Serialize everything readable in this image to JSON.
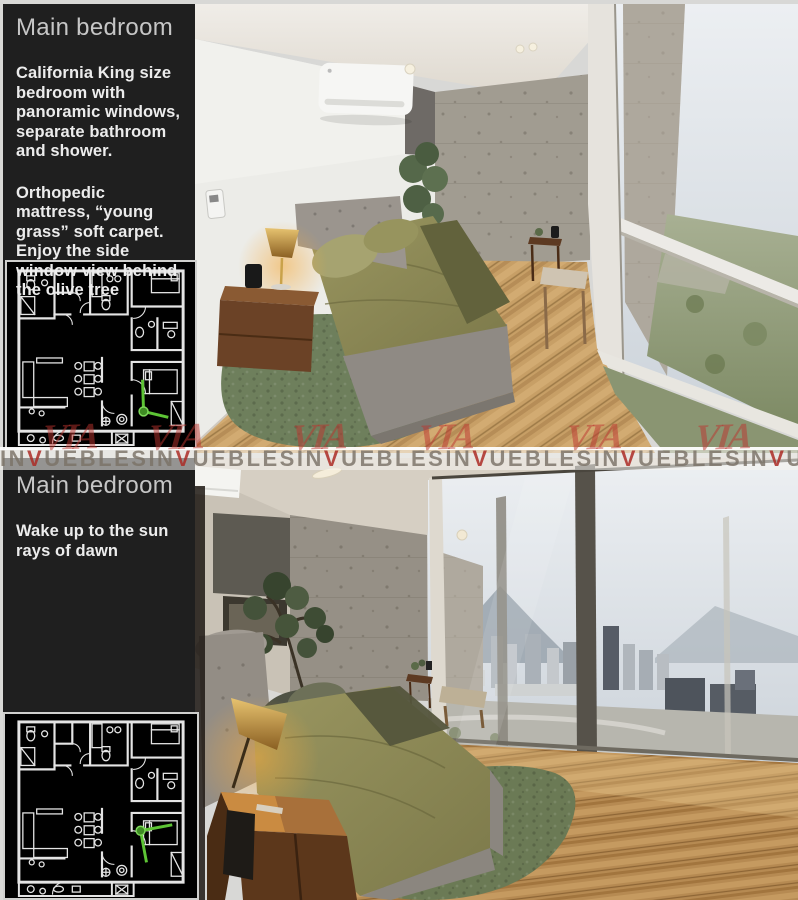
{
  "sections": [
    {
      "title": "Main bedroom",
      "paragraphs": [
        "California King size bedroom with panoramic windows, separate bathroom and shower.",
        "Orthopedic mattress, “young grass” soft carpet. Enjoy the side window view behind the olive tree"
      ]
    },
    {
      "title": "Main bedroom",
      "paragraphs": [
        "Wake up to the sun rays of dawn"
      ]
    }
  ],
  "watermark": {
    "prefix": "IN",
    "red_letter": "V",
    "suffix": "UEBLES",
    "repeats": 6,
    "logo_text": "VIA",
    "logo_positions_x": [
      42,
      148,
      291,
      418,
      566,
      695
    ],
    "red_color": "#ac2c26",
    "letter_color": "#7a7267"
  },
  "floor_plan": {
    "wall_color": "#e4e4e4",
    "background": "#000000",
    "camera_marker_color": "#5dc435"
  },
  "colors": {
    "panel_background": "#1f1f1f",
    "rug_green": "#6e7f5c",
    "bedding_olive": "#8f8c58",
    "wood_floor": "#c79f66"
  }
}
